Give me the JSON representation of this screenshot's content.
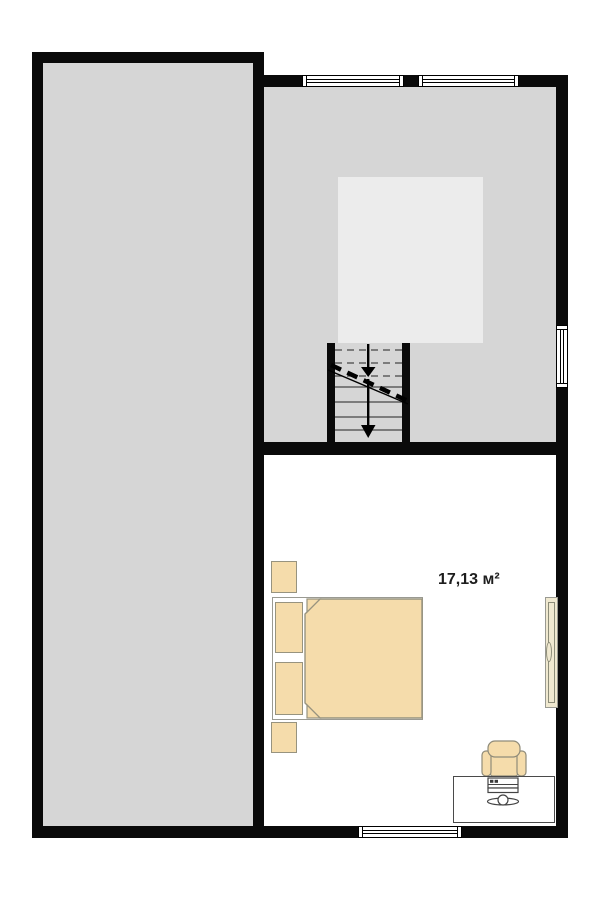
{
  "floorplan": {
    "bedroom": {
      "area_label": "17,13 м²"
    },
    "colors": {
      "wall": "#0a0a0a",
      "room_gray": "#d6d6d6",
      "stair_void_gray": "#ececec",
      "bedroom_white": "#ffffff",
      "furniture_beige": "#f5dcab",
      "door_panel_cream": "#f0e9d0",
      "furniture_outline": "#97937f",
      "desk_outline": "#4a4a4a"
    },
    "symbols": {
      "windows": [
        "top-window-left",
        "top-window-right",
        "right-wall-window",
        "bottom-window"
      ],
      "furniture": [
        "double-bed",
        "pillow-top",
        "pillow-bottom",
        "blanket",
        "nightstand-top",
        "nightstand-bottom",
        "desk",
        "office-chair",
        "keyboard",
        "desk-gadget",
        "door-panel"
      ],
      "stairs": {
        "down_arrows": 2,
        "dashed_upper_flight": true
      }
    }
  }
}
